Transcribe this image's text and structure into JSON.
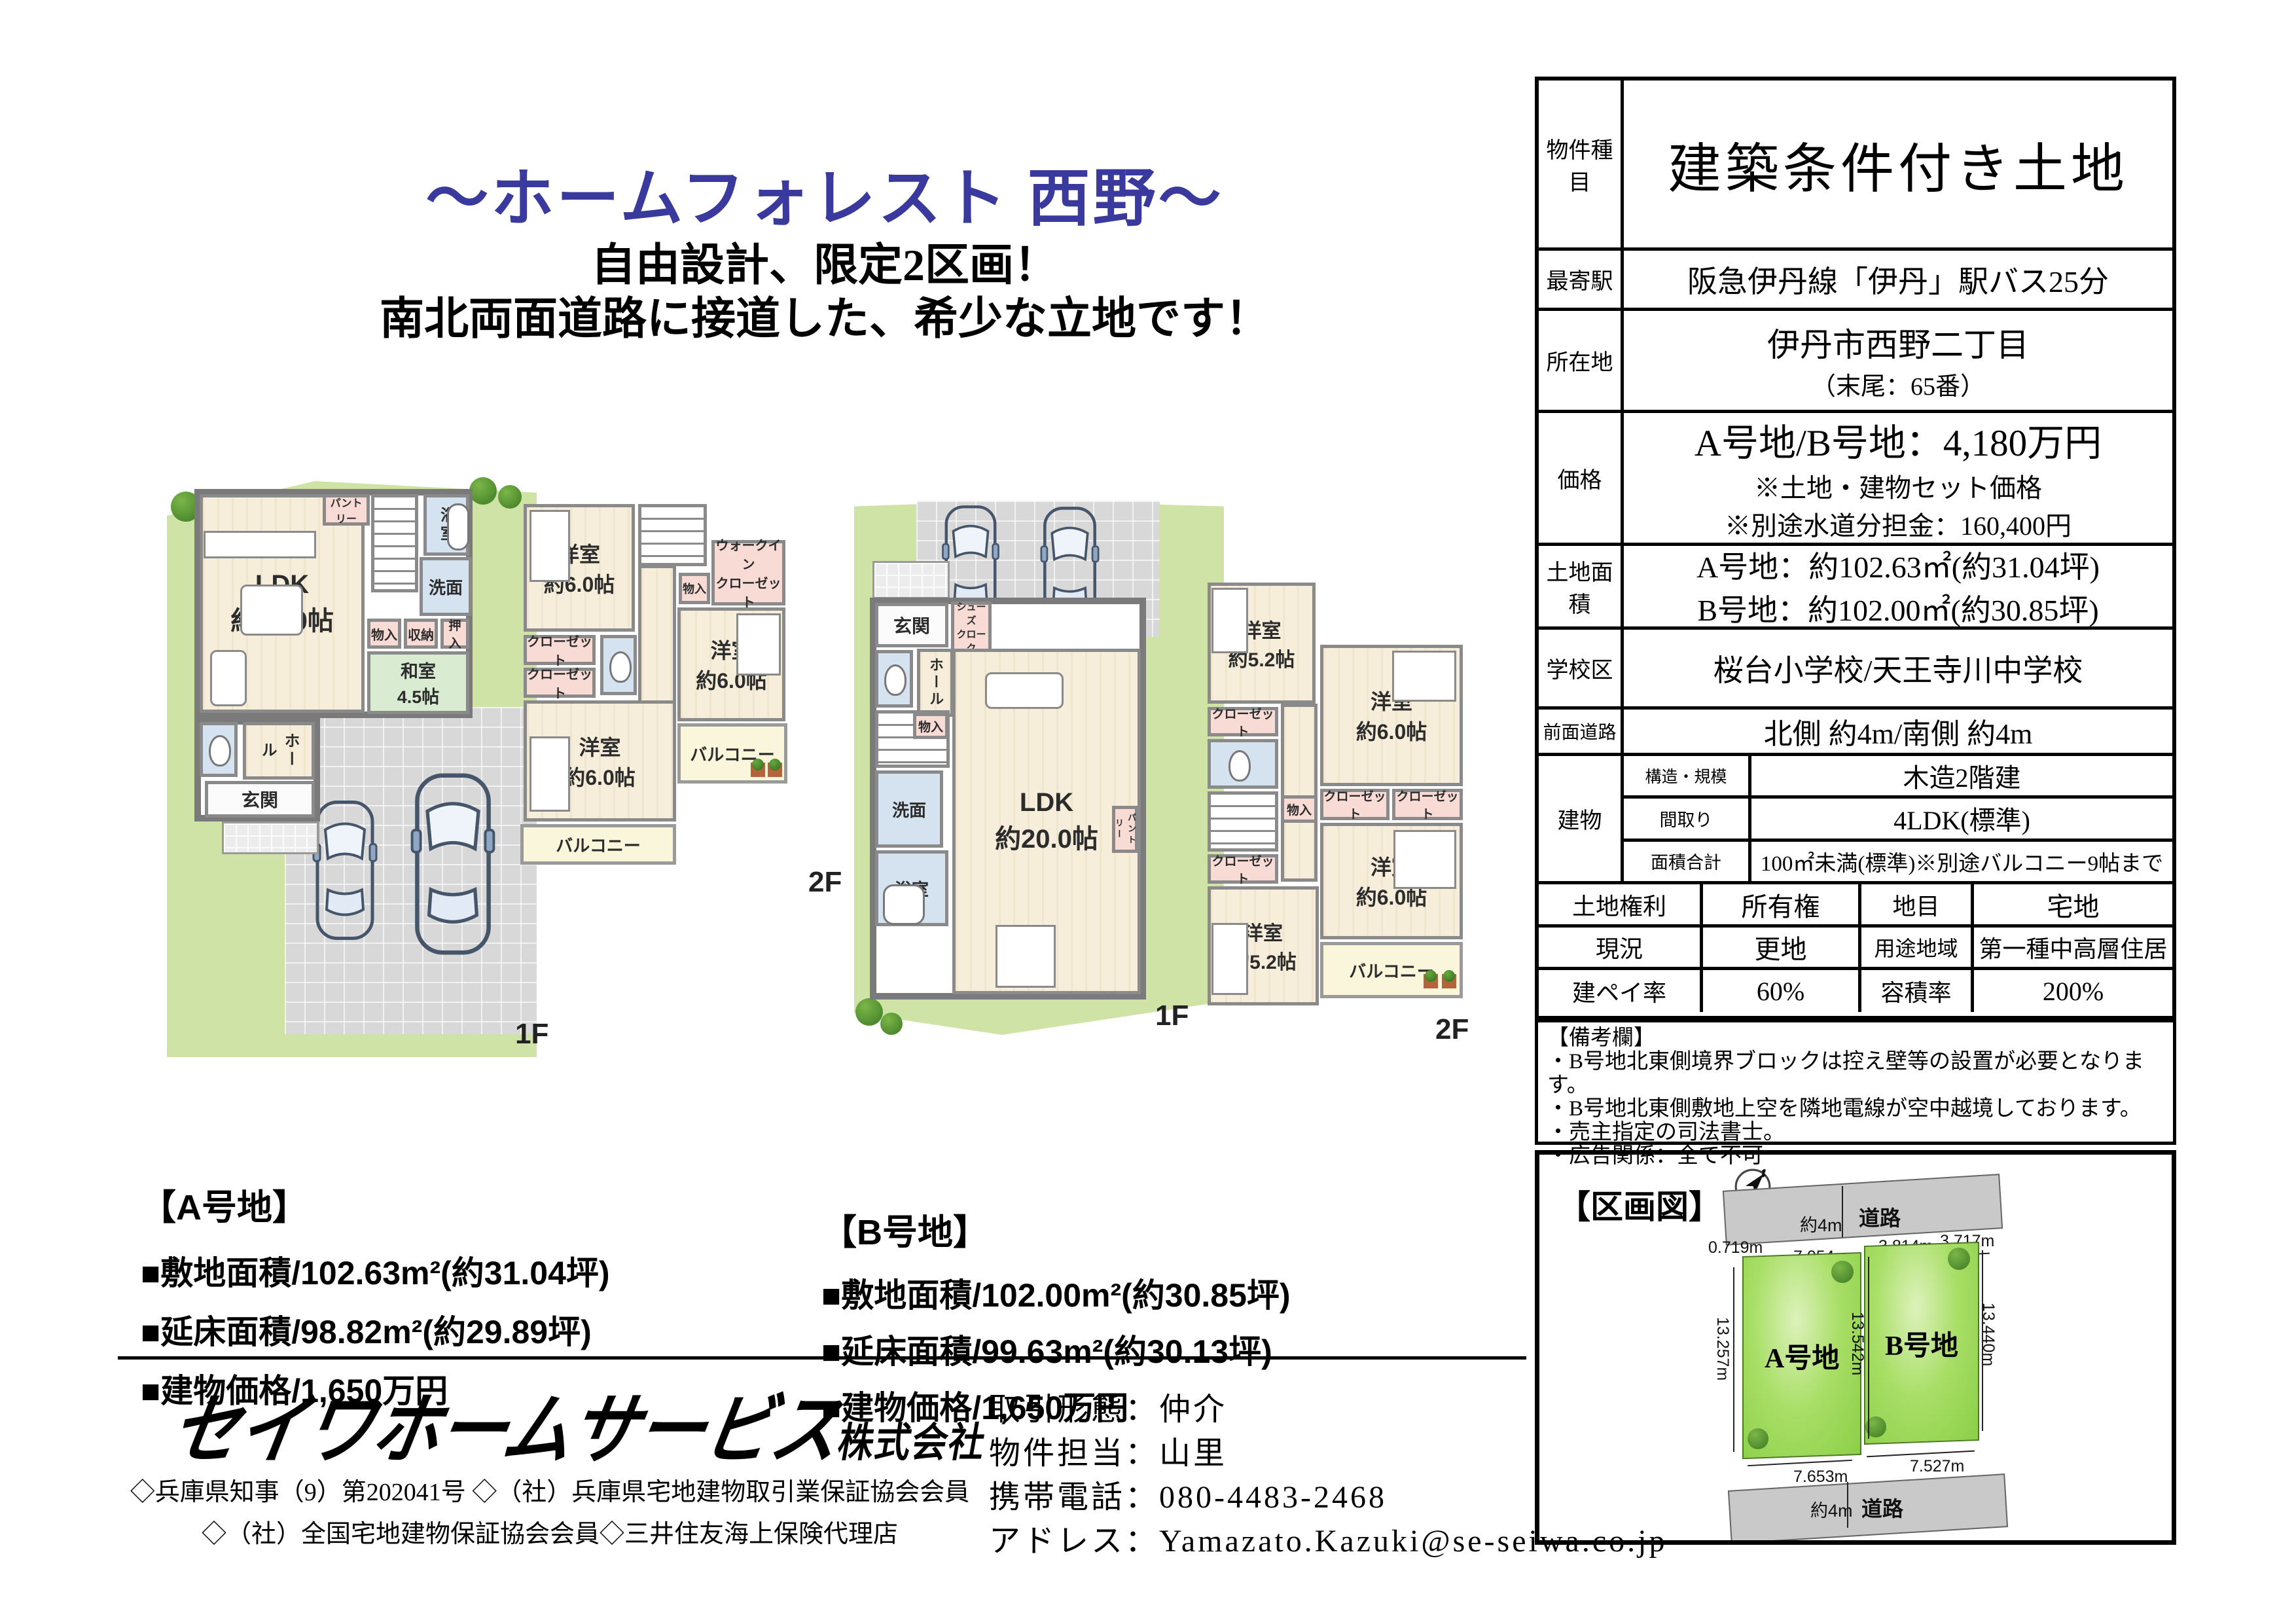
{
  "header": {
    "title": "〜ホームフォレスト 西野〜",
    "subtitle1": "自由設計、限定2区画！",
    "subtitle2": "南北両面道路に接道した、希少な立地です！"
  },
  "plans": {
    "a1f": {
      "floor": "1F",
      "ldk_name": "LDK",
      "ldk_size": "約18.0帖",
      "pantry": "パントリー",
      "bath": "浴室",
      "wash": "洗面",
      "storage1": "物入",
      "storage2": "収納",
      "storage3": "押入",
      "washitsu_name": "和室",
      "washitsu_size": "4.5帖",
      "hall": "ホール",
      "genkan": "玄関"
    },
    "a2f": {
      "floor": "2F",
      "room_nw_name": "洋室",
      "room_nw_size": "約6.0帖",
      "storage": "物入",
      "wic_line1": "ウォークイン",
      "wic_line2": "クローゼット",
      "closet1": "クローゼット",
      "closet2": "クローゼット",
      "room_e_name": "洋室",
      "room_e_size": "約6.0帖",
      "room_sw_name": "洋室",
      "room_sw_size": "約6.0帖",
      "balcony_s": "バルコニー",
      "balcony_e": "バルコニー"
    },
    "b1f": {
      "floor": "1F",
      "genkan": "玄関",
      "shoes_line1": "シューズ",
      "shoes_line2": "クローク",
      "hall": "ホール",
      "storage": "物入",
      "wash": "洗面",
      "bath": "浴室",
      "ldk_name": "LDK",
      "ldk_size": "約20.0帖",
      "pantry": "パントリー"
    },
    "b2f": {
      "floor": "2F",
      "room_nw_name": "洋室",
      "room_nw_size": "約5.2帖",
      "closet1": "クローゼット",
      "room_ne_name": "洋室",
      "room_ne_size": "約6.0帖",
      "storage": "物入",
      "closet2": "クローゼット",
      "closet3": "クローゼット",
      "closet4": "クローゼット",
      "room_e_name": "洋室",
      "room_e_size": "約6.0帖",
      "room_sw_name": "洋室",
      "room_sw_size": "約5.2帖",
      "balcony": "バルコニー"
    }
  },
  "lots": {
    "a": {
      "title": "【A号地】",
      "area": "■敷地面積/102.63m²(約31.04坪)",
      "floor_area": "■延床面積/98.82m²(約29.89坪)",
      "price": "■建物価格/1,650万円"
    },
    "b": {
      "title": "【B号地】",
      "area": "■敷地面積/102.00m²(約30.85坪)",
      "floor_area": "■延床面積/99.63m²(約30.13坪)",
      "price": "■建物価格/1,650万円"
    }
  },
  "footer": {
    "company_name": "セイワホームサービス",
    "company_suffix": "株式会社",
    "license1": "◇兵庫県知事（9）第202041号 ◇（社）兵庫県宅地建物取引業保証協会会員",
    "license2": "◇（社）全国宅地建物保証協会会員◇三井住友海上保険代理店",
    "contact": {
      "type": "取引形態：仲介",
      "agent": "物件担当：山里",
      "phone": "携帯電話：080-4483-2468",
      "email": "アドレス：Yamazato.Kazuki@se-seiwa.co.jp"
    }
  },
  "table": {
    "property_type": {
      "label": "物件種目",
      "value": "建築条件付き土地"
    },
    "station": {
      "label": "最寄駅",
      "value": "阪急伊丹線「伊丹」駅バス25分"
    },
    "location": {
      "label": "所在地",
      "value": "伊丹市西野二丁目",
      "note": "（末尾：65番）"
    },
    "price": {
      "label": "価格",
      "value": "A号地/B号地：4,180万円",
      "note1": "※土地・建物セット価格",
      "note2": "※別途水道分担金：160,400円"
    },
    "land_area": {
      "label": "土地面積",
      "line1": "A号地：約102.63㎡(約31.04坪)",
      "line2": "B号地：約102.00㎡(約30.85坪)"
    },
    "school": {
      "label": "学校区",
      "value": "桜台小学校/天王寺川中学校"
    },
    "front_road": {
      "label": "前面道路",
      "value": "北側 約4m/南側 約4m"
    },
    "building": {
      "label": "建物",
      "rows": [
        {
          "label": "構造・規模",
          "value": "木造2階建"
        },
        {
          "label": "間取り",
          "value": "4LDK(標準)"
        },
        {
          "label": "面積合計",
          "value": "100㎡未満(標準)※別途バルコニー9帖まで"
        }
      ]
    },
    "rights": {
      "label1": "土地権利",
      "value1": "所有権",
      "label2": "地目",
      "value2": "宅地"
    },
    "status": {
      "label1": "現況",
      "value1": "更地",
      "label2": "用途地域",
      "value2": "第一種中高層住居"
    },
    "ratio": {
      "label1": "建ペイ率",
      "value1": "60%",
      "label2": "容積率",
      "value2": "200%"
    }
  },
  "remarks": {
    "title": "【備考欄】",
    "lines": [
      "・B号地北東側境界ブロックは控え壁等の設置が必要となります。",
      "・B号地北東側敷地上空を隣地電線が空中越境しております。",
      "・売主指定の司法書士。",
      "・広告関係：全て不可"
    ]
  },
  "plot": {
    "title": "【区画図】",
    "road_top": "道路",
    "road_top_width": "約4m",
    "dim0": "0.719m",
    "dim_a_top": "7.054m",
    "dim_b_top1": "3.814m",
    "dim_b_top2": "3.717m",
    "lot_a": "A号地",
    "lot_b": "B号地",
    "dim_left": "13.257m",
    "dim_mid": "13.542m",
    "dim_right": "13.440m",
    "dim_a_bottom": "7.653m",
    "dim_b_bottom": "7.527m",
    "road_bottom": "道路",
    "road_bottom_width": "約4m"
  }
}
